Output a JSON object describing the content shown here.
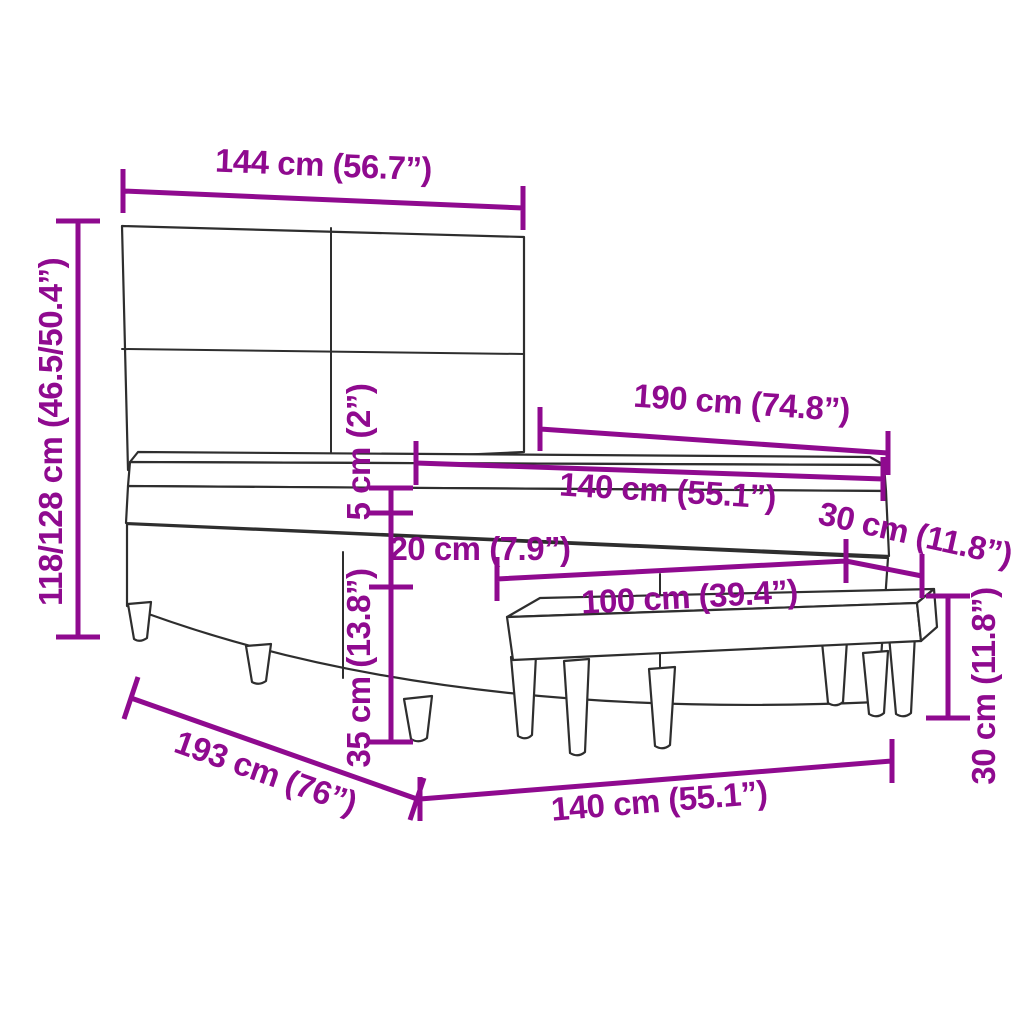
{
  "title": "Bed with tufted headboard and bench - dimension diagram",
  "colors": {
    "dimension": "#8F0A8F",
    "linework": "#2E2E2E",
    "background": "#FFFFFF"
  },
  "dimensions": {
    "headboard_width": "144 cm (56.7”)",
    "headboard_height": "118/128 cm (46.5/50.4”)",
    "bed_length": "190 cm (74.8”)",
    "mattress_width": "140 cm (55.1”)",
    "topper_height": "5 cm (2”)",
    "mattress_height": "20 cm (7.9”)",
    "base_height": "35 cm (13.8”)",
    "bench_width": "100 cm (39.4”)",
    "bench_depth": "30 cm (11.8”)",
    "bench_height": "30 cm (11.8”)",
    "bed_depth": "193 cm (76”)",
    "bed_width": "140 cm (55.1”)"
  }
}
